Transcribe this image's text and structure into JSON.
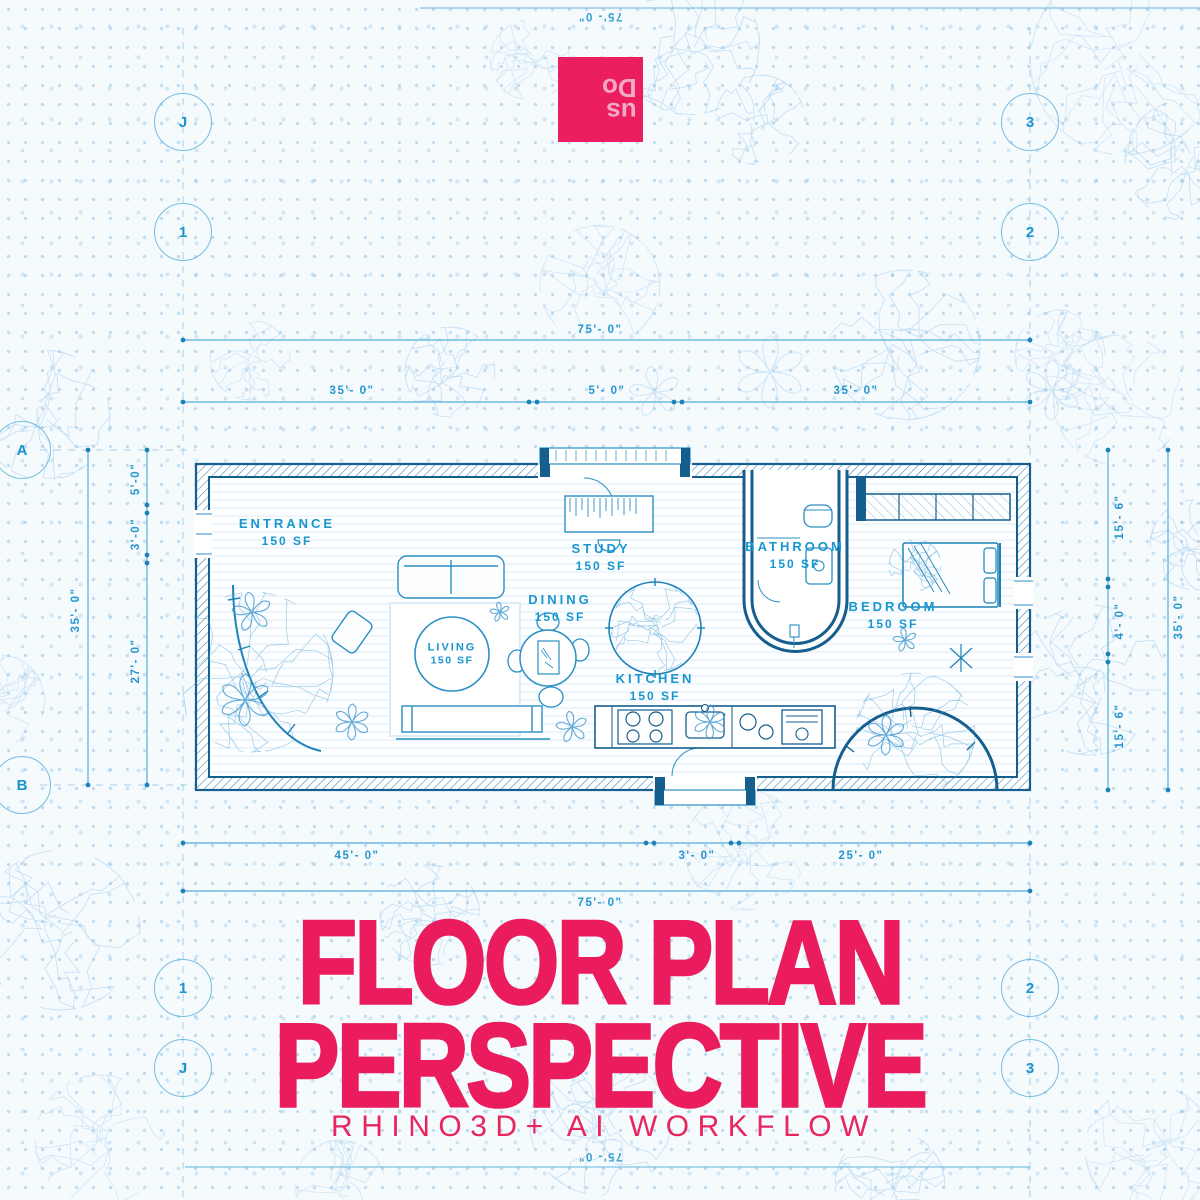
{
  "poster": {
    "title_line1": "FLOOR PLAN",
    "title_line2": "PERSPECTIVE",
    "subtitle": "RHINO3D+ AI WORKFLOW",
    "accent_color": "#EA1C5E",
    "blueprint_line_color": "#2a8fc4",
    "wall_color": "#155e8e",
    "label_color": "#1796cf"
  },
  "logo": {
    "name": "dous-logo",
    "lines": [
      "us",
      "Do"
    ],
    "square_color": "#EB1F60",
    "text_color": "#F2A9C4"
  },
  "rooms": [
    {
      "name": "ENTRANCE",
      "area": "150 SF"
    },
    {
      "name": "STUDY",
      "area": "150 SF"
    },
    {
      "name": "DINING",
      "area": "150 SF"
    },
    {
      "name": "LIVING",
      "area": "150 SF"
    },
    {
      "name": "KITCHEN",
      "area": "150 SF"
    },
    {
      "name": "BATHROOM",
      "area": "150 SF"
    },
    {
      "name": "BEDROOM",
      "area": "150 SF"
    }
  ],
  "dimensions": {
    "top_total": "75'- 0\"",
    "top_segments": [
      "35'- 0\"",
      "5'- 0\"",
      "35'- 0\""
    ],
    "bottom_segments": [
      "45'- 0\"",
      "3'- 0\"",
      "25'- 0\""
    ],
    "bottom_total": "75'- 0\"",
    "left_outer": "35'- 0\"",
    "left_segments": [
      "5'-0\"",
      "3'-0\"",
      "27'- 0\""
    ],
    "right_segments": [
      "15'- 6\"",
      "4'- 0\"",
      "15'- 6\""
    ],
    "right_outer": "35'- 0\"",
    "edge_top": "75'- 0\"",
    "edge_bottom": "75'- 0\""
  },
  "grid_bubbles": {
    "top_left_outer": "J",
    "top_right_outer": "3",
    "top_left_inner": "1",
    "top_right_inner": "2",
    "left_upper": "A",
    "left_lower": "B",
    "bottom_left_inner": "1",
    "bottom_right_inner": "2",
    "bottom_left_outer": "J",
    "bottom_right_outer": "3"
  }
}
